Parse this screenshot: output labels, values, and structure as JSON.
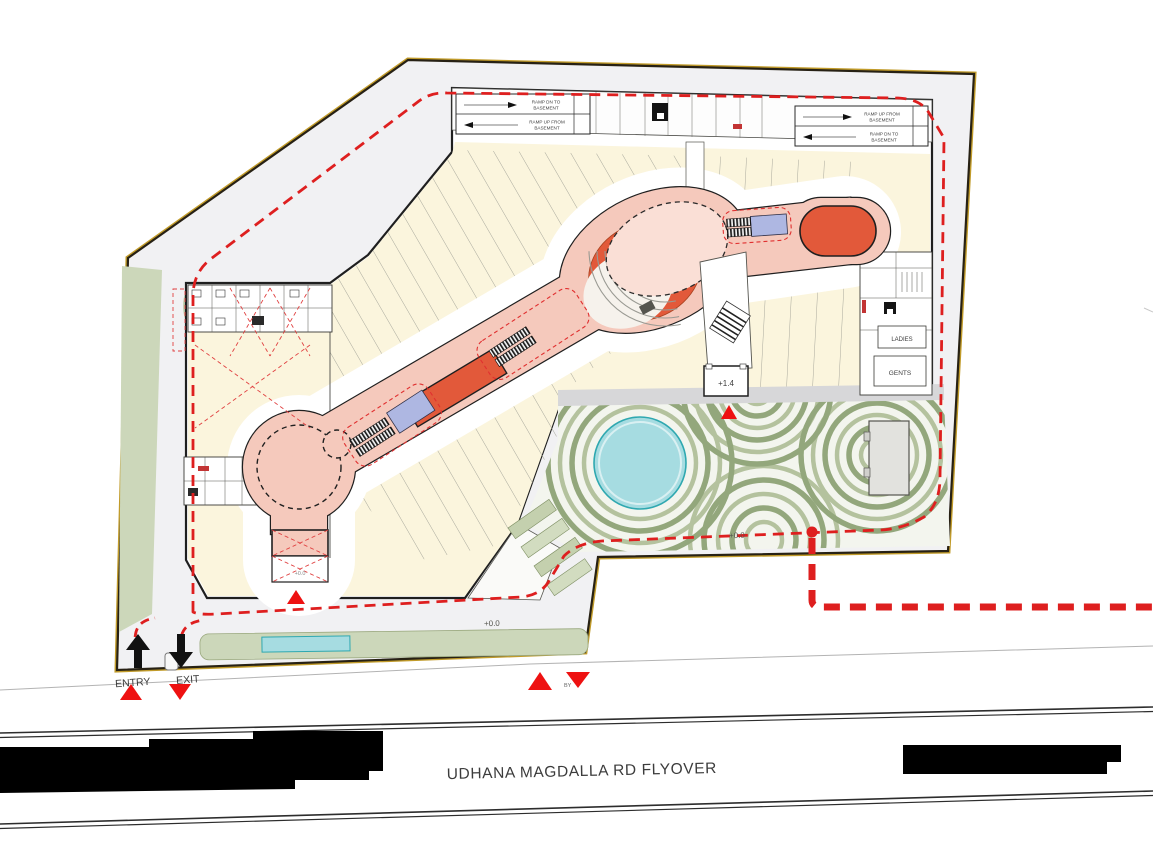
{
  "plan": {
    "road_label": "UDHANA MAGDALLA RD FLYOVER",
    "entry_label": "ENTRY",
    "exit_label": "EXIT",
    "by_marker": "BY",
    "ladies_label": "LADIES",
    "gents_label": "GENTS",
    "level_plus_14": "+1.4",
    "level_zero": "+0.0",
    "ramp_left": {
      "l1a": "RAMP DN TO",
      "l1b": "BASEMENT",
      "l2a": "RAMP UP FROM",
      "l2b": "BASEMENT"
    },
    "ramp_right": {
      "l1a": "RAMP UP FROM",
      "l1b": "BASEMENT",
      "l2a": "RAMP DN TO",
      "l2b": "BASEMENT"
    }
  },
  "colors": {
    "fire_red": "#de1f1f",
    "spine_pink": "#f5c9bc",
    "pale_pink": "#fadfd6",
    "feature_orange": "#e2593a",
    "escalator_blue": "#aeb7e2",
    "pool_teal": "#a6dce1",
    "sage_green": "#ccd7ba",
    "ring_green": "#b4c29e",
    "retail_cream": "#fbf5dd",
    "walkway_gray": "#f0f0f2",
    "boundary_gold": "#c19b2a",
    "wall_dark": "#1f1f1f"
  }
}
